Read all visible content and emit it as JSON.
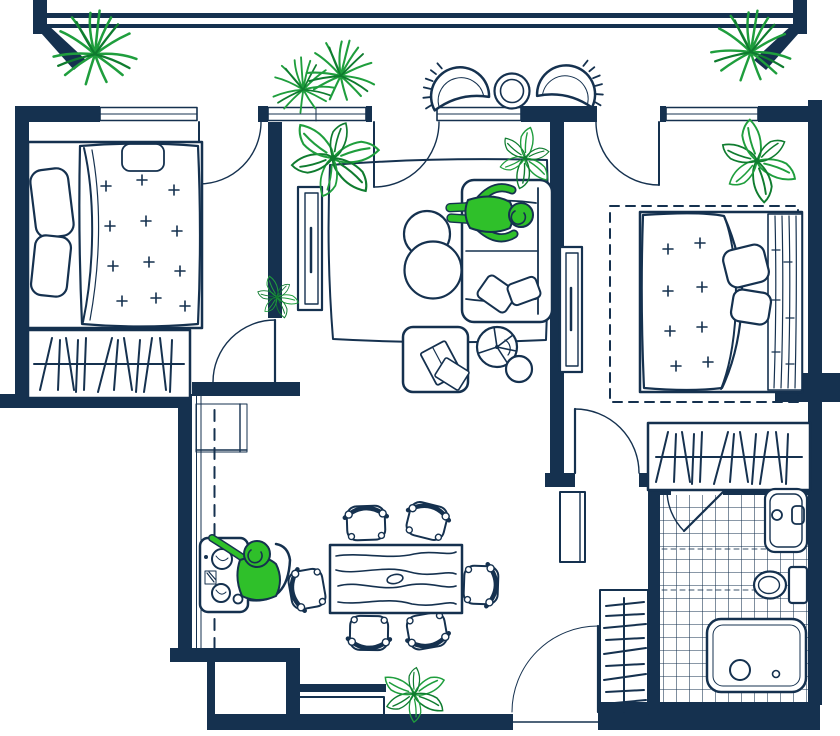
{
  "title": "Two-bedroom apartment floor plan with balcony",
  "canvas": {
    "width": 840,
    "height": 736
  },
  "colors": {
    "bg": "#ffffff",
    "ink": "#15314f",
    "green1": "#1f9e3d",
    "green2": "#0f7c2f",
    "person": "#2fc02a"
  },
  "rooms": [
    {
      "id": "balcony",
      "label": "balcony",
      "furniture": [
        "potted-palm",
        "potted-palm-pair",
        "potted-palm",
        "wicker-chair",
        "wicker-chair",
        "round-side-table"
      ]
    },
    {
      "id": "bedroom-left",
      "label": "left bedroom",
      "furniture": [
        "double-bed",
        "pillow",
        "pillow",
        "folded-throw",
        "wardrobe-with-hangers"
      ]
    },
    {
      "id": "living-room",
      "label": "living room",
      "furniture": [
        "tv-console",
        "rug",
        "pouf",
        "pouf",
        "sofa",
        "sofa-pillow",
        "sofa-pillow",
        "coffee-table",
        "open-book",
        "round-tray",
        "side-stool",
        "potted-plant",
        "potted-plant",
        "potted-plant"
      ]
    },
    {
      "id": "bedroom-right",
      "label": "right bedroom",
      "furniture": [
        "rug",
        "double-bed",
        "pillow",
        "pillow",
        "tv-console",
        "wardrobe-with-hangers",
        "potted-plant"
      ]
    },
    {
      "id": "dining-area",
      "label": "dining area",
      "furniture": [
        "dining-table",
        "chair",
        "chair",
        "chair",
        "chair",
        "chair",
        "chair"
      ]
    },
    {
      "id": "work-nook",
      "label": "work nook",
      "furniture": [
        "desk",
        "desk-chair",
        "desk-items"
      ]
    },
    {
      "id": "hallway",
      "label": "hallway and entry",
      "furniture": [
        "hall-cabinet",
        "coat-closet-with-hangers",
        "shoe-bench",
        "potted-plant"
      ]
    },
    {
      "id": "bathroom",
      "label": "bathroom",
      "furniture": [
        "wash-basin",
        "toilet",
        "bathtub",
        "tiled-floor"
      ]
    }
  ],
  "people": [
    {
      "id": "person-on-sofa",
      "pose": "lying on the sofa"
    },
    {
      "id": "person-at-desk",
      "pose": "seated at the desk"
    }
  ],
  "openings": {
    "windows": 4,
    "balcony_doors": 3,
    "room_doors": 3,
    "entry_doors": 1
  }
}
